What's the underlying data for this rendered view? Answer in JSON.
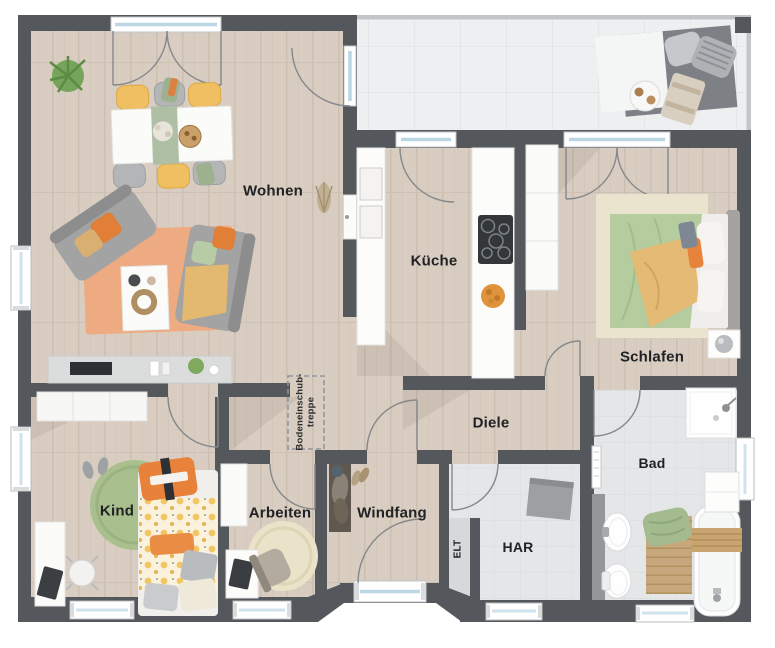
{
  "plan": {
    "rooms": {
      "wohnen": {
        "label": "Wohnen"
      },
      "kueche": {
        "label": "Küche"
      },
      "schlafen": {
        "label": "Schlafen"
      },
      "diele": {
        "label": "Diele"
      },
      "bad": {
        "label": "Bad"
      },
      "kind": {
        "label": "Kind"
      },
      "arbeiten": {
        "label": "Arbeiten"
      },
      "windfang": {
        "label": "Windfang"
      },
      "har": {
        "label": "HAR"
      },
      "elt": {
        "label": "ELT"
      }
    },
    "annotations": {
      "attic_stairs_line1": "Bodeneinschub-",
      "attic_stairs_line2": "treppe"
    },
    "palette": {
      "wall": "#54585c",
      "wood_floor": "#d8cdc0",
      "tile_floor": "#e4e6e8",
      "terrace_tile": "#edeff0",
      "accent_orange": "#e8833c",
      "accent_yellow": "#eec06a",
      "accent_green": "#b2cb9c",
      "rug_living": "#eeab82",
      "rug_kind": "#a9bf8e"
    }
  }
}
